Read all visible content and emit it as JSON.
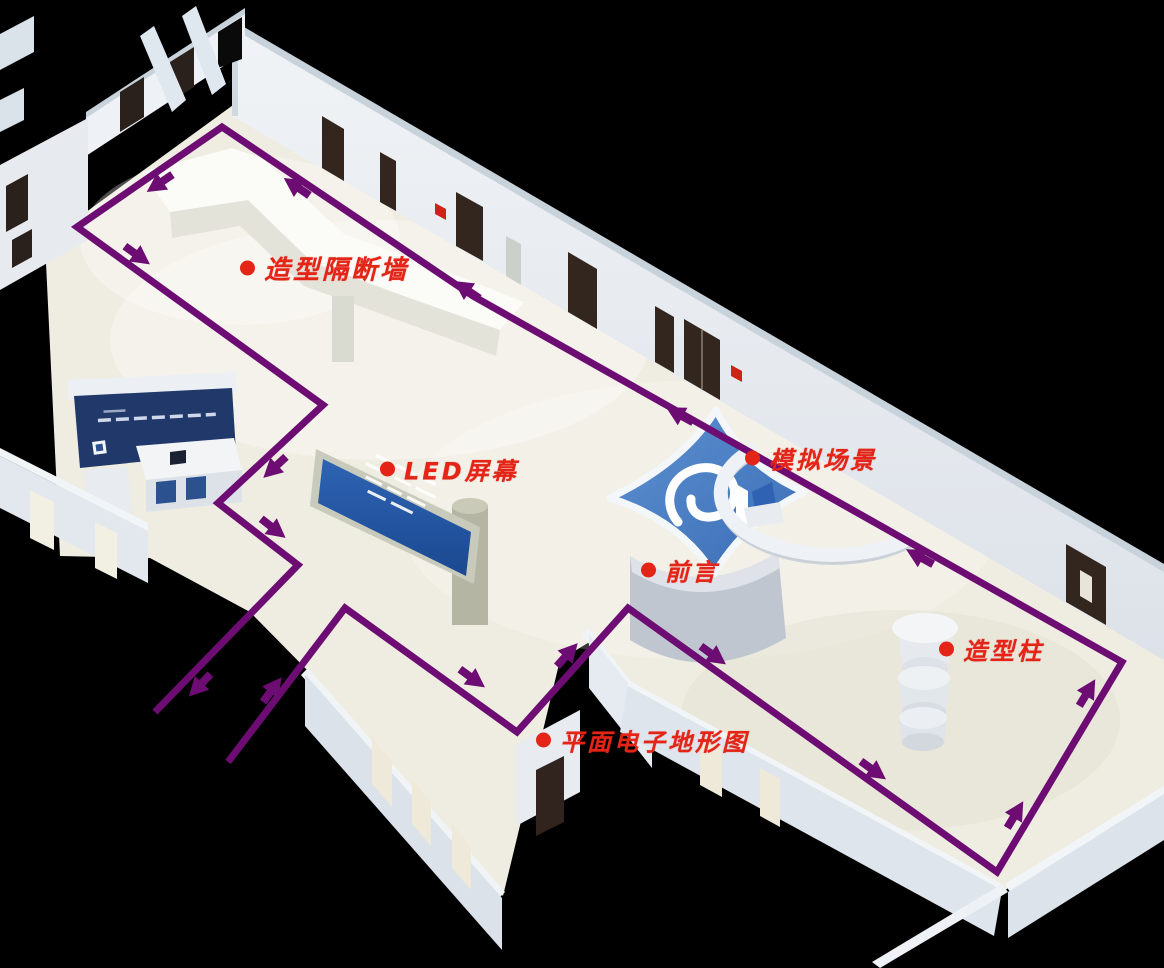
{
  "diagram": {
    "type": "3d-exhibition-hall-floorplan-with-tour-route",
    "background_color": "#000000",
    "floor_color": "#efece1",
    "wall_color": "#e9edf2",
    "accent_blue": "#3f74bd",
    "label_color": "#e32417",
    "annotations": [
      {
        "id": "partition-wall",
        "text": "造型隔断墙",
        "x": 248,
        "y": 268,
        "size": 26
      },
      {
        "id": "led-screen",
        "text": "LED屏幕",
        "x": 388,
        "y": 469,
        "size": 24
      },
      {
        "id": "simulated-scene",
        "text": "模拟场景",
        "x": 753,
        "y": 458,
        "size": 24
      },
      {
        "id": "preface",
        "text": "前言",
        "x": 649,
        "y": 570,
        "size": 24
      },
      {
        "id": "shaped-column",
        "text": "造型柱",
        "x": 947,
        "y": 649,
        "size": 24
      },
      {
        "id": "electronic-terrain-map",
        "text": "平面电子地形图",
        "x": 544,
        "y": 740,
        "size": 24
      }
    ],
    "route": {
      "color": "#6d0c72",
      "stroke_width": 7,
      "points": [
        [
          228,
          762
        ],
        [
          345,
          608
        ],
        [
          517,
          732
        ],
        [
          628,
          608
        ],
        [
          997,
          872
        ],
        [
          1122,
          662
        ],
        [
          700,
          424
        ],
        [
          473,
          296
        ],
        [
          222,
          127
        ],
        [
          77,
          227
        ],
        [
          323,
          405
        ],
        [
          218,
          503
        ],
        [
          298,
          565
        ],
        [
          155,
          712
        ]
      ],
      "arrows": [
        {
          "x": 272,
          "y": 690,
          "deg": -53
        },
        {
          "x": 472,
          "y": 678,
          "deg": 36
        },
        {
          "x": 567,
          "y": 655,
          "deg": -48
        },
        {
          "x": 713,
          "y": 655,
          "deg": 36
        },
        {
          "x": 873,
          "y": 770,
          "deg": 36
        },
        {
          "x": 1015,
          "y": 815,
          "deg": -59
        },
        {
          "x": 1087,
          "y": 693,
          "deg": -59
        },
        {
          "x": 920,
          "y": 557,
          "deg": 209
        },
        {
          "x": 680,
          "y": 415,
          "deg": 209
        },
        {
          "x": 467,
          "y": 290,
          "deg": 214
        },
        {
          "x": 297,
          "y": 187,
          "deg": 214
        },
        {
          "x": 160,
          "y": 183,
          "deg": 146
        },
        {
          "x": 137,
          "y": 255,
          "deg": 36
        },
        {
          "x": 275,
          "y": 467,
          "deg": 137
        },
        {
          "x": 273,
          "y": 528,
          "deg": 38
        },
        {
          "x": 200,
          "y": 685,
          "deg": 134
        }
      ]
    }
  }
}
